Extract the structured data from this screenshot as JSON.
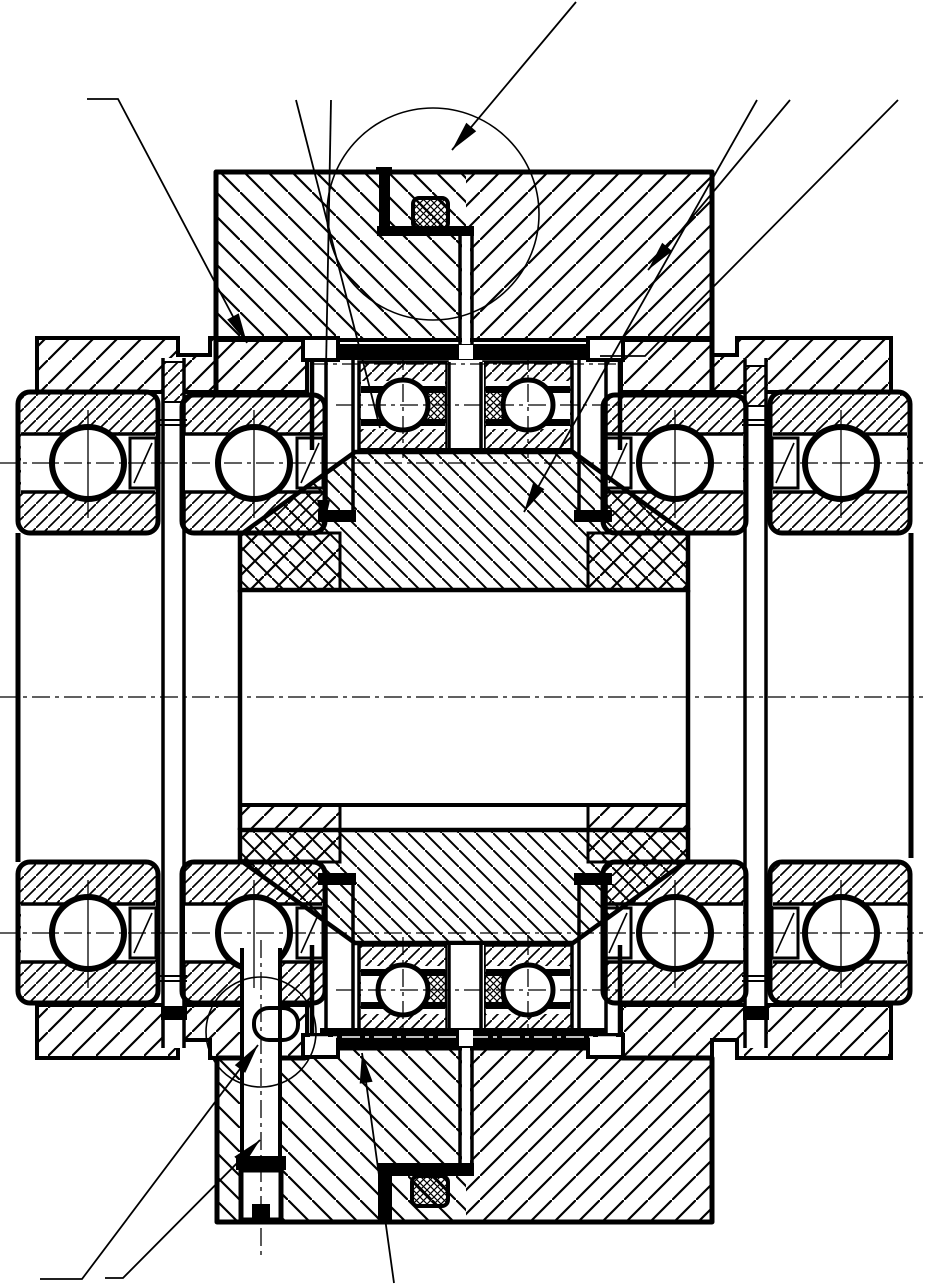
{
  "meta": {
    "title": "Mechanical section drawing - duplex bearing and housing assembly",
    "type": "engineering-cross-section",
    "visible_text": [],
    "palette": {
      "ink": "#000000",
      "paper": "#ffffff"
    }
  },
  "figure": {
    "components": [
      "upper-housing-cap",
      "lower-housing-cap",
      "left-outer-bearing",
      "left-inner-bearing",
      "right-inner-bearing",
      "right-outer-bearing",
      "left-outer-bearing-bottom",
      "left-inner-bearing-bottom",
      "right-inner-bearing-bottom",
      "right-outer-bearing-bottom",
      "upper-duplex-bearing-pair",
      "lower-duplex-bearing-pair",
      "gear-web",
      "gear-bore",
      "o-ring-seal-top",
      "o-ring-seal-bottom",
      "oil-tube",
      "tie-bolt-left",
      "tie-bolt-right",
      "clamp-bolt",
      "retainer-strip-top",
      "retainer-strip-bottom",
      "detail-circle-top",
      "detail-circle-bottom"
    ],
    "hatch_styles": {
      "cap_left": "backslash-wide",
      "cap_right": "slash-wide",
      "wings": "slash-wide",
      "bearing_races": "slash-dense",
      "gear": "backslash-medium",
      "seals_and_cages": "crosshatch"
    }
  },
  "overlay": {
    "detail_circles": [
      {
        "name": "detail-circle-top",
        "cx": 433,
        "cy": 214,
        "r": 106
      },
      {
        "name": "detail-circle-bottom",
        "cx": 261,
        "cy": 1032,
        "r": 55
      }
    ],
    "leader_lines": [
      {
        "name": "callout-housing-left",
        "points": [
          [
            87,
            99
          ],
          [
            118,
            99
          ],
          [
            247,
            343
          ]
        ],
        "arrow": true
      },
      {
        "name": "callout-bearing-stack",
        "points": [
          [
            296,
            100
          ],
          [
            380,
            428
          ]
        ],
        "arrow": false
      },
      {
        "name": "callout-sleeve-left",
        "points": [
          [
            331,
            100
          ],
          [
            323,
            530
          ]
        ],
        "arrow": true
      },
      {
        "name": "callout-oring-top",
        "points": [
          [
            576,
            2
          ],
          [
            452,
            150
          ]
        ],
        "arrow": true
      },
      {
        "name": "callout-cap-right",
        "points": [
          [
            790,
            100
          ],
          [
            648,
            270
          ]
        ],
        "arrow": true
      },
      {
        "name": "callout-gear-hub",
        "points": [
          [
            757,
            100
          ],
          [
            524,
            512
          ]
        ],
        "arrow": true
      },
      {
        "name": "callout-housing-step",
        "points": [
          [
            898,
            100
          ],
          [
            645,
            356
          ],
          [
            600,
            356
          ]
        ],
        "arrow": false
      },
      {
        "name": "callout-bolt-shank",
        "points": [
          [
            40,
            1279
          ],
          [
            82,
            1279
          ],
          [
            258,
            1045
          ]
        ],
        "arrow": true
      },
      {
        "name": "callout-bolt-thread",
        "points": [
          [
            105,
            1278
          ],
          [
            123,
            1278
          ],
          [
            260,
            1140
          ]
        ],
        "arrow": true
      },
      {
        "name": "callout-retainer-bottom",
        "points": [
          [
            394,
            1283
          ],
          [
            362,
            1053
          ]
        ],
        "arrow": true
      }
    ],
    "centerlines": [
      {
        "x1": 0,
        "y1": 463,
        "x2": 928,
        "y2": 463,
        "style": "dashdot"
      },
      {
        "x1": 0,
        "y1": 697,
        "x2": 928,
        "y2": 697,
        "style": "dashdot"
      },
      {
        "x1": 0,
        "y1": 933,
        "x2": 928,
        "y2": 933,
        "style": "dashdot"
      },
      {
        "x1": 336,
        "y1": 405,
        "x2": 625,
        "y2": 405,
        "style": "dashdot"
      },
      {
        "x1": 336,
        "y1": 990,
        "x2": 625,
        "y2": 990,
        "style": "dashdot"
      },
      {
        "x1": 403,
        "y1": 352,
        "x2": 403,
        "y2": 458,
        "style": "dashdot"
      },
      {
        "x1": 528,
        "y1": 352,
        "x2": 528,
        "y2": 458,
        "style": "dashdot"
      },
      {
        "x1": 403,
        "y1": 937,
        "x2": 403,
        "y2": 1043,
        "style": "dashdot"
      },
      {
        "x1": 528,
        "y1": 937,
        "x2": 528,
        "y2": 1043,
        "style": "dashdot"
      },
      {
        "x1": 261,
        "y1": 940,
        "x2": 261,
        "y2": 1258,
        "style": "dashdot"
      },
      {
        "x1": 310,
        "y1": 364,
        "x2": 617,
        "y2": 364,
        "style": "dashdot"
      },
      {
        "x1": 310,
        "y1": 1037,
        "x2": 617,
        "y2": 1037,
        "style": "dashdot-white"
      },
      {
        "x1": 88,
        "y1": 410,
        "x2": 88,
        "y2": 518,
        "style": "solid"
      },
      {
        "x1": 254,
        "y1": 410,
        "x2": 254,
        "y2": 518,
        "style": "solid"
      },
      {
        "x1": 675,
        "y1": 410,
        "x2": 675,
        "y2": 518,
        "style": "solid"
      },
      {
        "x1": 841,
        "y1": 410,
        "x2": 841,
        "y2": 518,
        "style": "solid"
      },
      {
        "x1": 88,
        "y1": 880,
        "x2": 88,
        "y2": 988,
        "style": "solid"
      },
      {
        "x1": 254,
        "y1": 880,
        "x2": 254,
        "y2": 988,
        "style": "solid"
      },
      {
        "x1": 675,
        "y1": 880,
        "x2": 675,
        "y2": 988,
        "style": "solid"
      },
      {
        "x1": 841,
        "y1": 880,
        "x2": 841,
        "y2": 988,
        "style": "solid"
      }
    ]
  },
  "bearings": {
    "corner_ball_radius": 36,
    "duplex_ball_radius": 25,
    "corner_balls": [
      {
        "cx": 88,
        "cy": 463
      },
      {
        "cx": 254,
        "cy": 463
      },
      {
        "cx": 675,
        "cy": 463
      },
      {
        "cx": 841,
        "cy": 463
      },
      {
        "cx": 88,
        "cy": 933
      },
      {
        "cx": 254,
        "cy": 933
      },
      {
        "cx": 675,
        "cy": 933
      },
      {
        "cx": 841,
        "cy": 933
      }
    ],
    "duplex_balls": [
      {
        "cx": 403,
        "cy": 405
      },
      {
        "cx": 528,
        "cy": 405
      },
      {
        "cx": 403,
        "cy": 990
      },
      {
        "cx": 528,
        "cy": 990
      }
    ]
  }
}
